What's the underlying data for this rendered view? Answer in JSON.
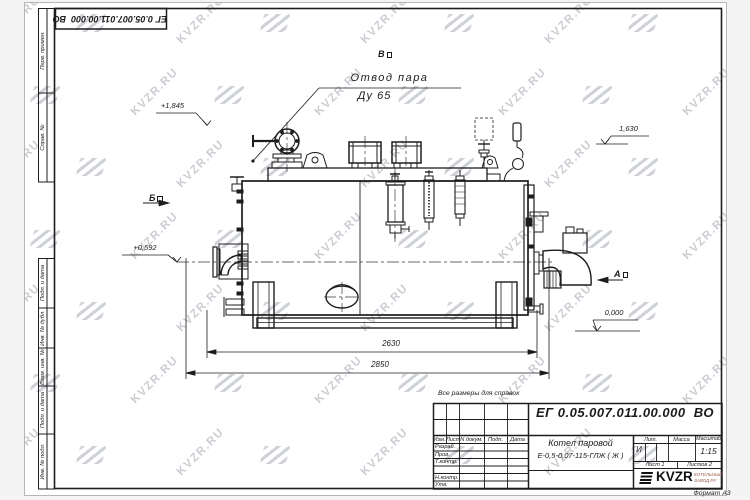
{
  "watermark": {
    "text": "KVZR.RU",
    "color": "#c9cdd2"
  },
  "corner_stamp": {
    "doc_number": "ЕГ 0.05.007.011.00.000  ВО"
  },
  "margin_fields": {
    "fields": [
      "Перв. примен.",
      "Справ. №",
      "Подп. и дата",
      "Инв. № дубл.",
      "Взам. инв. №",
      "Подп. и дата",
      "Инв. № подл."
    ]
  },
  "drawing": {
    "callout": {
      "line1": "Отвод пара",
      "line2": "Ду 65"
    },
    "view_markers": {
      "top": "В",
      "left": "Б",
      "right": "А"
    },
    "elevations": {
      "steam_outlet": "+1,845",
      "right_level": "1,630",
      "axis_level": "+0,592",
      "ground": "0,000"
    },
    "dimensions": {
      "frame_length": "2630",
      "overall_length": "2850"
    }
  },
  "title_block": {
    "note": "Все размеры для справок",
    "doc_number": "ЕГ 0.05.007.011.00.000  ВО",
    "product_line1": "Котел паровой",
    "product_line2": "Е-0,5-0,07-115-ГЛЖ ( Ж )",
    "headers": {
      "izm": "Изм.",
      "list": "Лист",
      "doc": "N докум.",
      "podp": "Подп.",
      "data": "Дата"
    },
    "rows": [
      "Разраб.",
      "Пров.",
      "Т.контр.",
      "Н.контр.",
      "Утв."
    ],
    "lit": {
      "header": "Лит.",
      "value": "И"
    },
    "mass": {
      "header": "Масса"
    },
    "scale": {
      "header": "Масштаб",
      "value": "1:15"
    },
    "sheet": "Лист 1",
    "sheets": "Листов 2",
    "logo": {
      "name": "KVZR",
      "sub1": "КОТЕЛЬНЫЙ",
      "sub2": "ЗАВОД.РУ"
    },
    "format": "Формат А3"
  }
}
